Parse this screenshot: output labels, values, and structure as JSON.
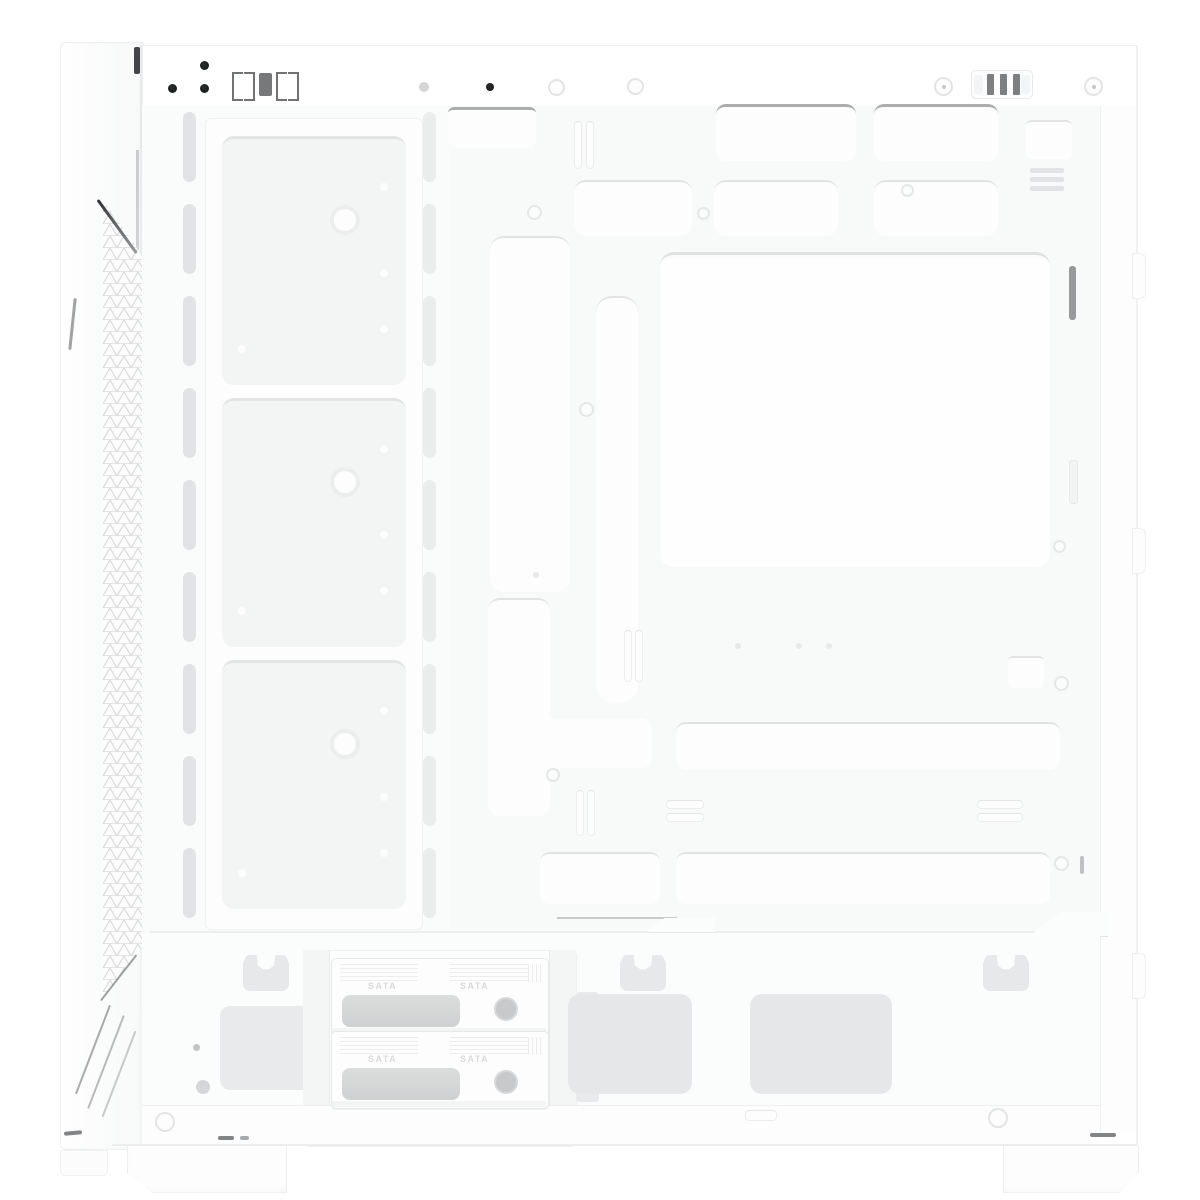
{
  "product": {
    "type": "pc-case-interior-product-photo",
    "description": "White mid-tower PC case, side panel removed, interior side view",
    "color_scheme": "white"
  },
  "labels": {
    "drive_tray": "SATA"
  },
  "colors": {
    "background": "#ffffff",
    "chassis": "#fbfcfc",
    "cutout": "#fdfdfe",
    "slot": "#e2e3e4",
    "pad": "#e6e7e8",
    "screw_dot": "#1f2022",
    "clip_slot": "#7d7f81",
    "mesh_line": "#d9dadb",
    "streak": "#56585a"
  },
  "structure": {
    "front_fan_mounts": 3,
    "front_rail_slots_per_side": 9,
    "drive_trays": 2,
    "sata_labels_per_tray": 2,
    "feet": 2,
    "top_clip_slots": 3,
    "bottom_anchor_clips": 3,
    "bottom_vent_pads": 2,
    "rear_edge_tabs": 3
  }
}
